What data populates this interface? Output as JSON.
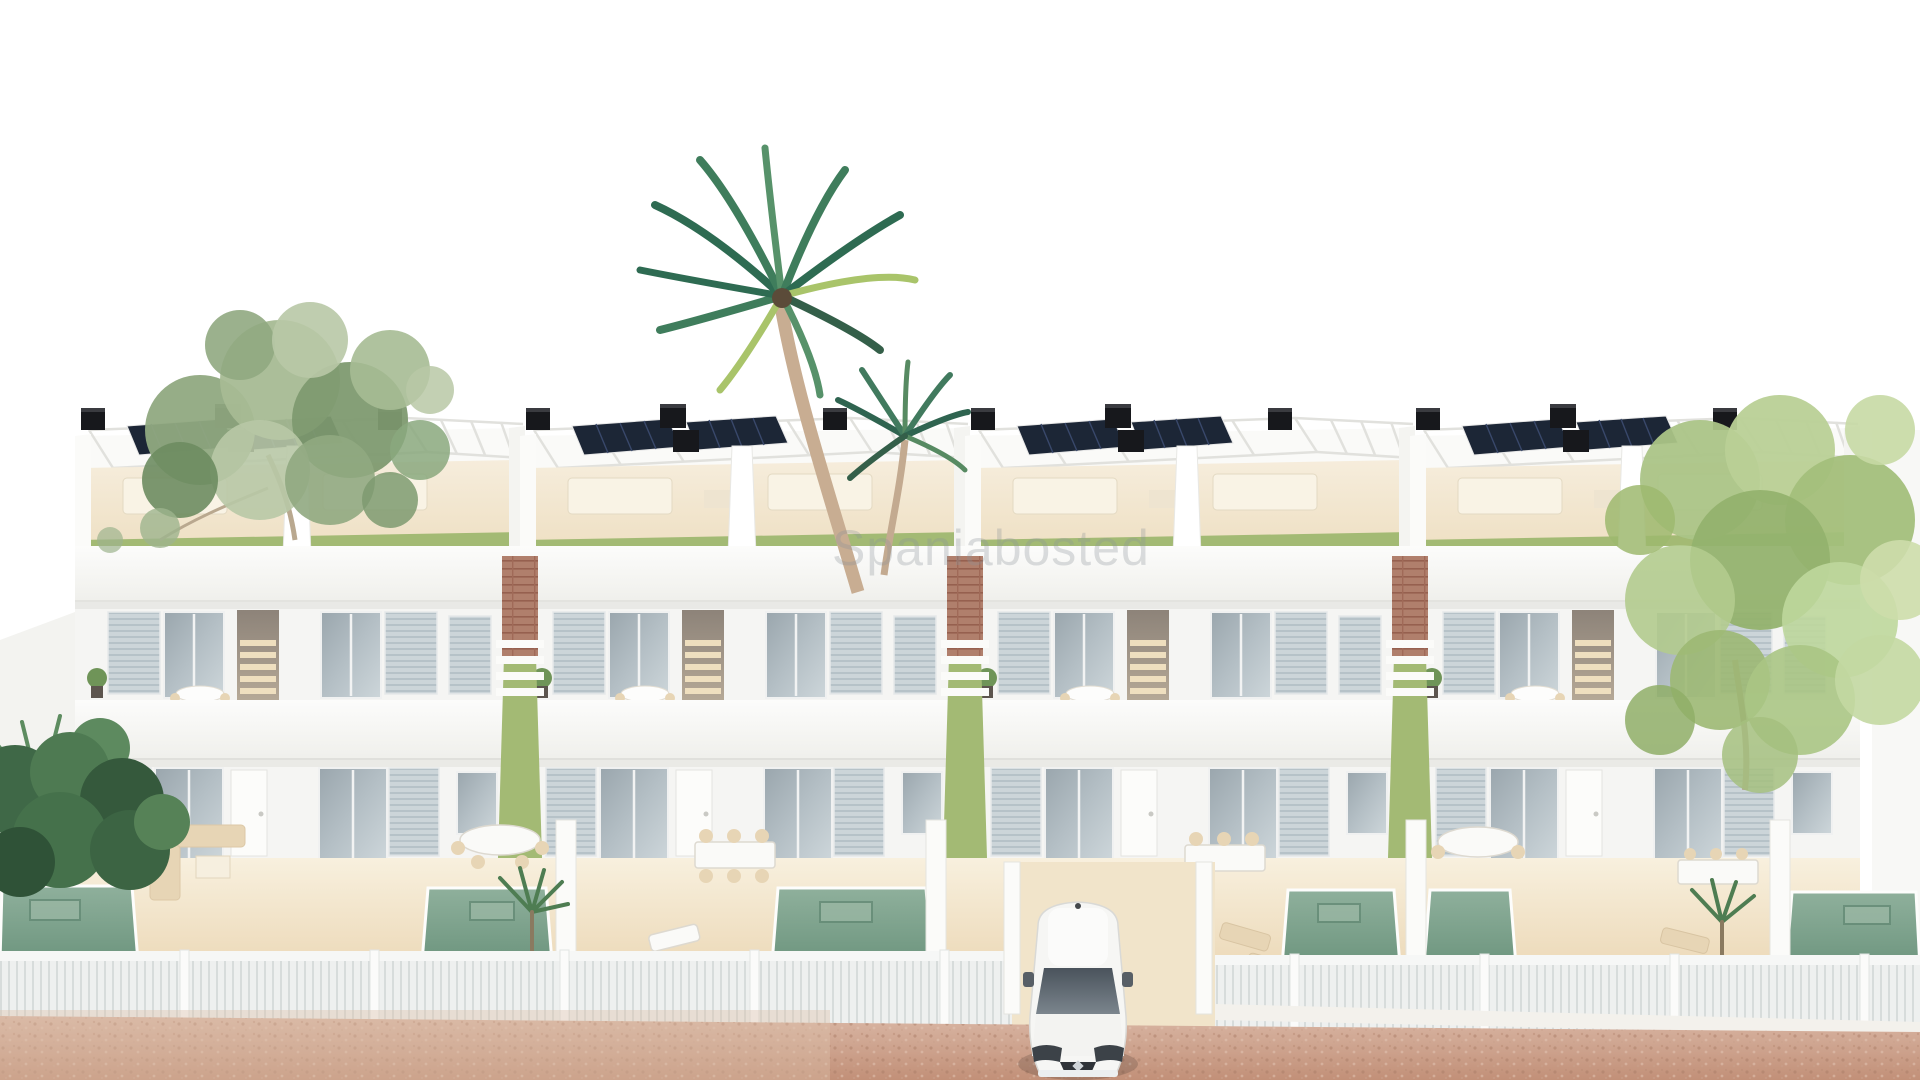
{
  "meta": {
    "type": "3d-architectural-render",
    "subject": "Row of modern white two-storey villas with roof terraces, pergolas, solar panels, private pools and palm trees",
    "view": "elevated front aerial view",
    "image_width": 1920,
    "image_height": 1080
  },
  "watermark": {
    "text": "Spaniabosted",
    "color": "rgba(140,146,152,0.30)"
  },
  "scene": {
    "villa_blocks": 4,
    "units_per_block": 2,
    "solar_panels_per_roof": 2,
    "rooftop_units": "black chimney / AC boxes on parapets",
    "pools_visible": 6,
    "vehicle": "white hatchback car parked in central driveway",
    "vegetation": [
      "sage-green deciduous tree top left",
      "tall coconut palm centre",
      "small palm centre",
      "light-green tree right side",
      "dark tropical shrubs bottom left",
      "small garden palms in patios"
    ],
    "ground_elements": [
      "cream garden terraces with dining sets and sun loungers",
      "white slatted front fences",
      "brick accent walls between blocks",
      "grass side passages",
      "pink sandy unpaved road in foreground"
    ]
  },
  "palette": {
    "sky": "#ffffff",
    "wall": "#f5f5f3",
    "wallShade": "#e9e9e6",
    "cream": "#f3e7cf",
    "grass": "#a3ba74",
    "pool": "#7fa18e",
    "poolDark": "#5f8671",
    "glass": "#b4bfc5",
    "louver": "#ccd5d9",
    "brick": "#b07f6c",
    "solar": "#1c2636",
    "black": "#17181c",
    "road": "#d1a795",
    "sand": "#dcc0ab",
    "fence": "#eef0ef",
    "treeLeft": "#90a981",
    "treeRight": "#abc487",
    "palmGreen": "#3f7d5c",
    "palmLight": "#a9c46a",
    "bush": "#45714b",
    "furniture": "#e7d5b5",
    "carBody": "#f6f6f4",
    "carGlass": "#525b64"
  }
}
